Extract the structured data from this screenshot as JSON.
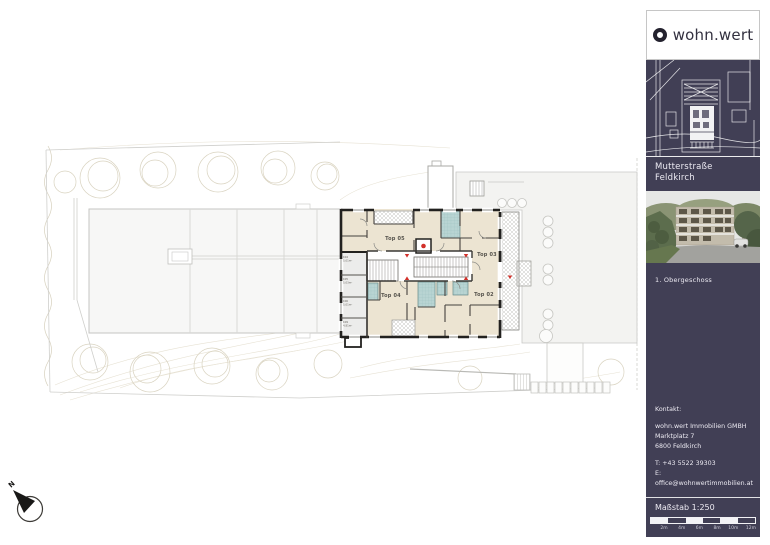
{
  "sidebar": {
    "logo_text": "wohn.wert",
    "project": {
      "line1": "Mutterstraße",
      "line2": "Feldkirch"
    },
    "floor_label": "1. Obergeschoss",
    "contact": {
      "heading": "Kontakt:",
      "company": "wohn.wert Immobilien GMBH",
      "street": "Marktplatz 7",
      "city": "6800 Feldkirch",
      "phone": "T: +43 5522 39303",
      "email": "E: office@wohnwertimmobilien.at"
    },
    "scale": {
      "label": "Maßstab 1:250",
      "ticks": [
        "2m",
        "4m",
        "6m",
        "8m",
        "10m",
        "12m"
      ]
    },
    "colors": {
      "navy": "#413f55"
    }
  },
  "plan": {
    "apartments": [
      {
        "id": "top-05",
        "label": "Top 05"
      },
      {
        "id": "top-03",
        "label": "Top 03"
      },
      {
        "id": "top-04",
        "label": "Top 04"
      },
      {
        "id": "top-02",
        "label": "Top 02"
      }
    ],
    "storage_rooms": [
      {
        "id": "K04",
        "area": "5,01m²"
      },
      {
        "id": "K05",
        "area": "5,03m²"
      },
      {
        "id": "K06",
        "area": "5,01m²"
      },
      {
        "id": "K09",
        "area": "4,81m²"
      }
    ],
    "north_label": "N",
    "colors": {
      "floor_cream": "#ece4d2",
      "bath_teal": "#b8d4d3",
      "wall": "#22211f",
      "marker_red": "#d2302a"
    }
  }
}
